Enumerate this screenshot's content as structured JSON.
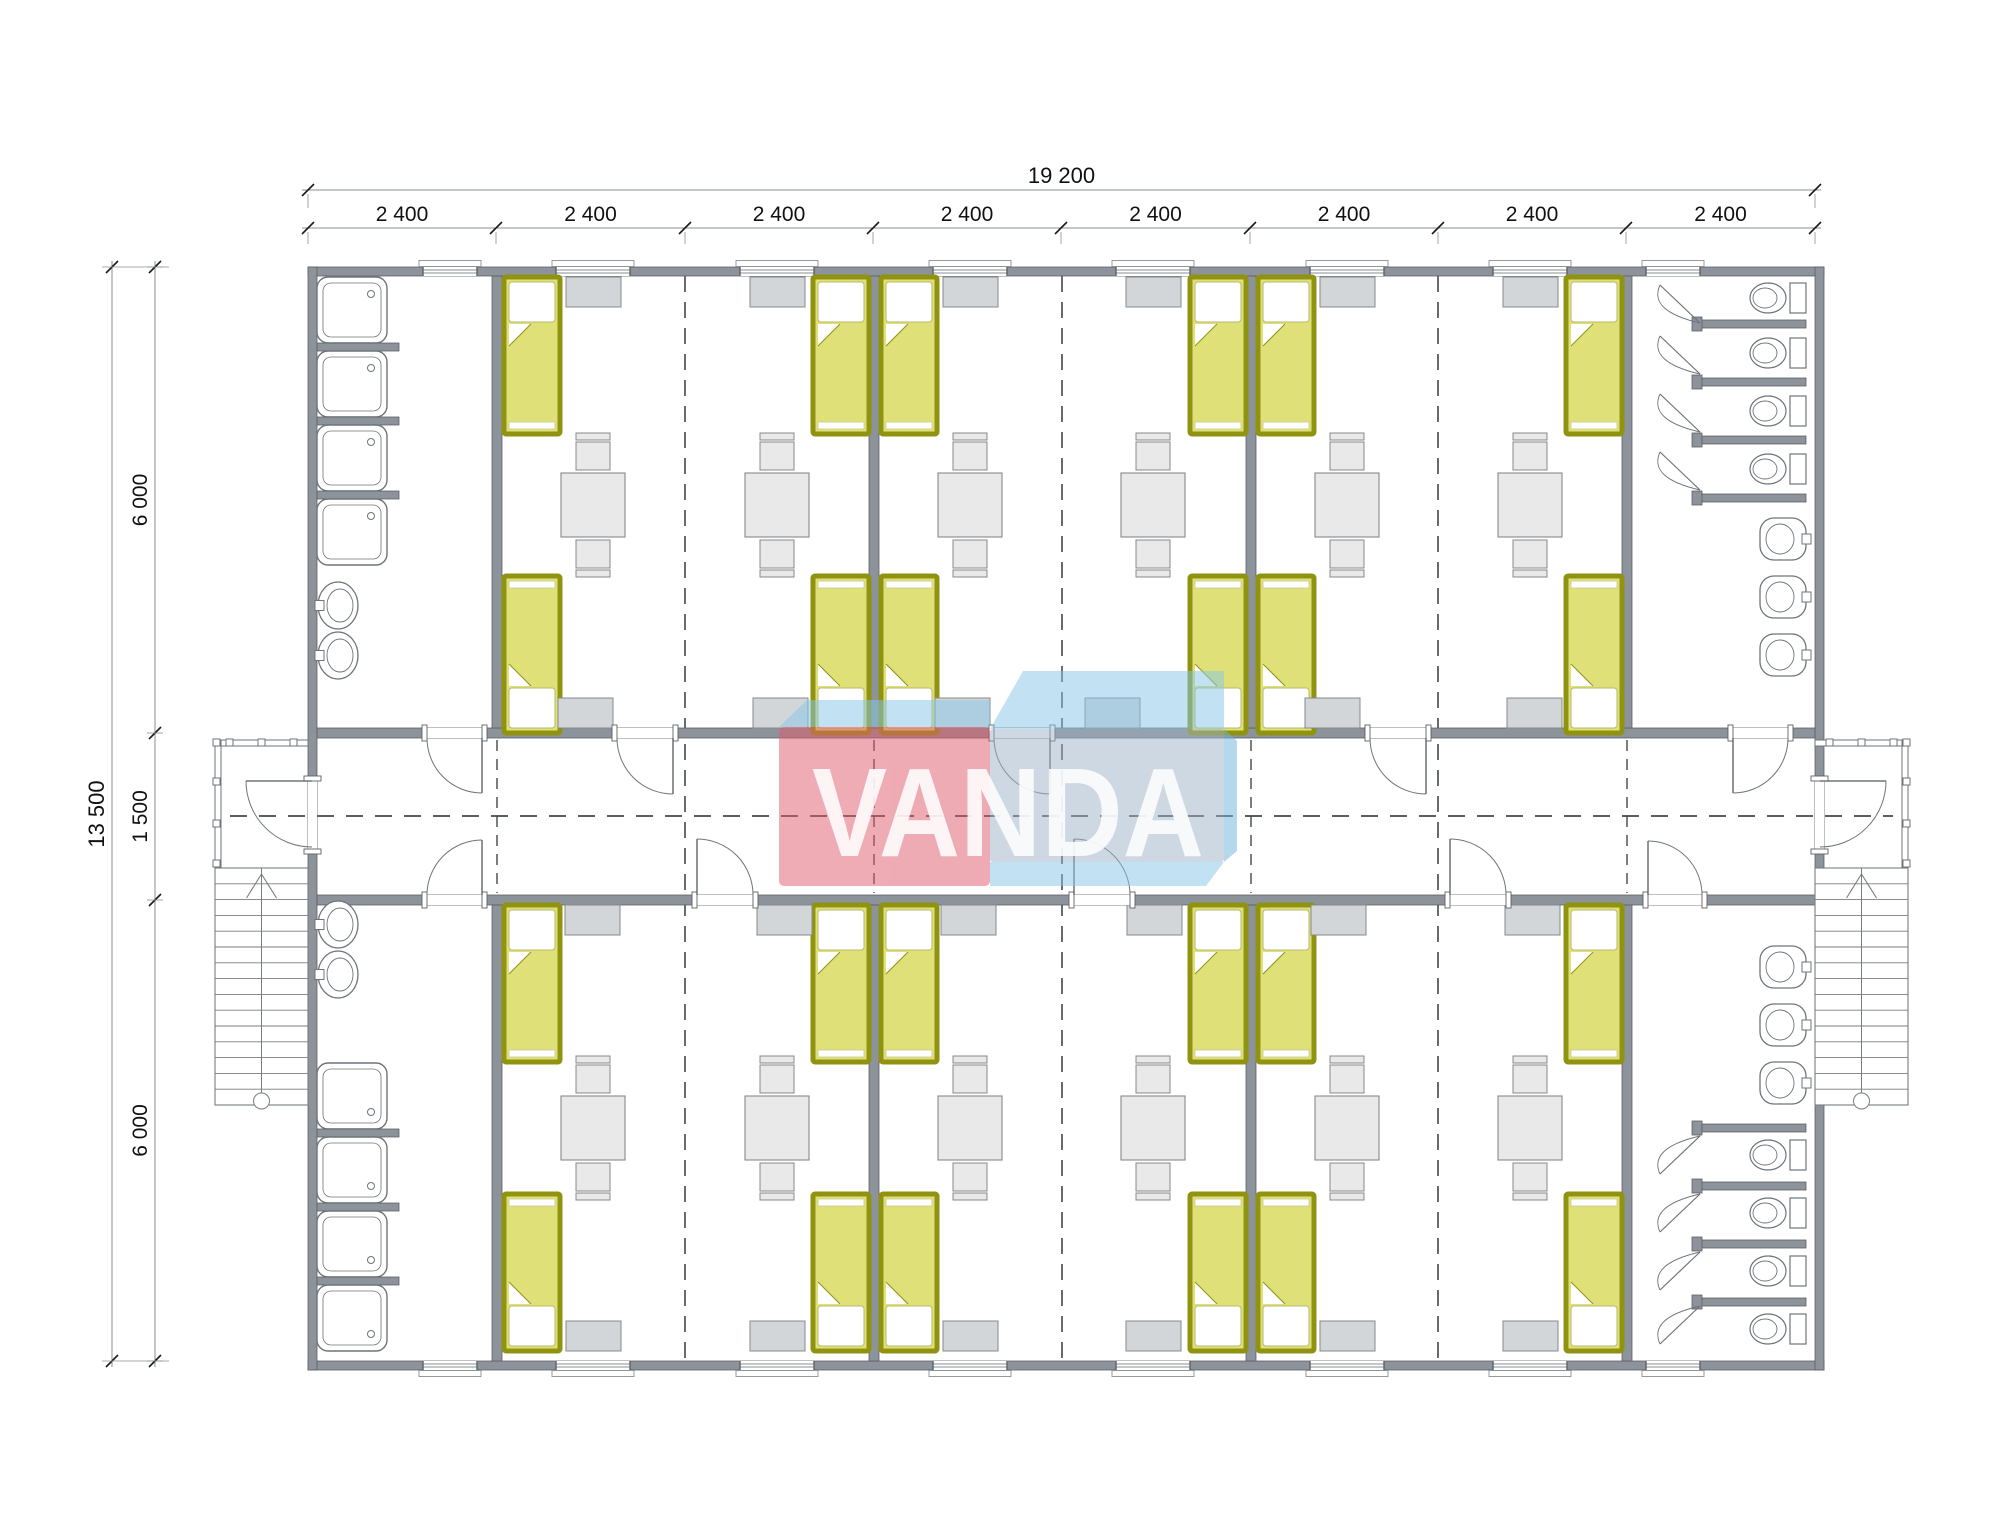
{
  "title": "Modular dormitory floor plan",
  "watermark": {
    "text": "VANDA",
    "red": "#e15a6b",
    "blue_top": "#87c7e9",
    "blue_front": "#9db3c7",
    "blue_edge": "#6fb3dd"
  },
  "dimensions": {
    "top_total_label": "19 200",
    "top_segment_label": "2 400",
    "top_segment_count": 8,
    "left_total_label": "13 500",
    "left_segment_labels": [
      "6 000",
      "1 500",
      "6 000"
    ]
  },
  "colors": {
    "wall": "#8d939a",
    "wallStroke": "#5d6165",
    "bedFill": "#dfe077",
    "bedBorder": "#8f9310",
    "furn": "#e9e9e9",
    "furnStroke": "#85898d",
    "wardrobe": "#d3d6d8",
    "fixture": "#6e747a",
    "dash": "#42474b",
    "dimLine": "#8a8f93",
    "dimTick": "#1a1a1a",
    "stair": "#787d81",
    "textColor": "#111111"
  },
  "geometry": {
    "canvas": {
      "w": 2000,
      "h": 1539
    },
    "bld": {
      "x0": 308,
      "x1": 1815,
      "y0": 267,
      "y1": 1361,
      "wt": 9
    },
    "corr": {
      "t0": 728,
      "t1": 738,
      "b0": 895,
      "b1": 905
    },
    "moduleBoundaries": [
      308,
      496,
      685,
      873,
      1061,
      1250,
      1438,
      1626,
      1815
    ],
    "partitionCenters": [
      497,
      874,
      1251,
      1627
    ],
    "jointX": [
      685,
      1062,
      1438
    ],
    "moduleCenters": [
      593,
      777,
      970,
      1153,
      1347,
      1530
    ],
    "centerline": {
      "x0": 230,
      "x1": 1893,
      "y": 816
    },
    "beds": {
      "w": 56,
      "l": 157,
      "leftX": [
        504,
        881,
        1258
      ],
      "rightX": [
        813,
        1190,
        1566
      ],
      "topBandTopY": 277,
      "topBandBotY": 576,
      "botBandTopY": 905,
      "botBandBotY": 1194
    },
    "tables": {
      "size": 64,
      "cyTop": 505,
      "cyBot": 1128
    },
    "wardrobe": {
      "w": 55,
      "h": 30,
      "windowTopY": 277,
      "windowBotY": 1321,
      "corrTopY": 698,
      "corrBotY": 905,
      "corrTopX": [
        558,
        753,
        935,
        1085,
        1305,
        1507
      ],
      "corrBotX": [
        565,
        757,
        941,
        1127,
        1311,
        1505
      ]
    },
    "windows": {
      "roomW": 74,
      "roomX": [
        556,
        740,
        933,
        1116,
        1310,
        1493
      ],
      "washW": 54,
      "washX": [
        423,
        1646
      ]
    },
    "doors": {
      "roomW": 56,
      "topRooms": [
        617,
        994,
        1370
      ],
      "botRooms": [
        697,
        1074,
        1450
      ],
      "washTop": [
        [
          427,
          482
        ],
        [
          1733,
          1788
        ]
      ],
      "washBot": [
        [
          427,
          482
        ],
        [
          1648,
          1702
        ]
      ],
      "endY0": 781,
      "endY1": 849
    },
    "washLeft": {
      "showerX": 317,
      "showerW": 70,
      "showerH": 66,
      "stubW": 82,
      "topShowerY": [
        277,
        351,
        425,
        499
      ],
      "botShowerY": [
        1063,
        1137,
        1211,
        1285
      ],
      "sinkX": 318,
      "sinkW": 40,
      "sinkH": 47,
      "topSinkY": [
        582,
        632
      ],
      "botSinkY": [
        901,
        951
      ]
    },
    "washRight": {
      "stallX": 1700,
      "stallLen": 106,
      "stallT": 8,
      "topStallY": [
        320,
        378,
        436,
        494
      ],
      "botStallY": [
        1124,
        1182,
        1240,
        1298
      ],
      "toiletTopCY": [
        298,
        353,
        411,
        469
      ],
      "toiletBotCY": [
        1155,
        1213,
        1271,
        1329
      ],
      "sinkX": 1760,
      "sinkW": 46,
      "sinkH": 42,
      "topSinkY": [
        518,
        576,
        634
      ],
      "botSinkY": [
        946,
        1004,
        1062
      ]
    },
    "porch": {
      "leftX": 215,
      "rightX": 1815,
      "w": 93,
      "y0": 740,
      "y1": 868,
      "railT": 6
    },
    "stairs": {
      "y0": 868,
      "y1": 1105,
      "treads": 14,
      "circleY": 1101,
      "circleR": 8
    },
    "dims": {
      "topLine1Y": 190,
      "topLine2Y": 228,
      "leftLine1X": 112,
      "leftLine2X": 155,
      "leftTickY": [
        267,
        733,
        900,
        1361
      ]
    },
    "wm": {
      "topFaceLeft": [
        [
          779,
          727
        ],
        [
          807,
          700
        ],
        [
          990,
          700
        ],
        [
          990,
          727
        ]
      ],
      "red": [
        779,
        727,
        211,
        159
      ],
      "topFaceRight": [
        [
          990,
          729
        ],
        [
          1023,
          671
        ],
        [
          1224,
          671
        ],
        [
          1224,
          729
        ]
      ],
      "blueFront": [
        990,
        729,
        234,
        133
      ],
      "edgeRight": [
        [
          1224,
          729
        ],
        [
          1237,
          741
        ],
        [
          1237,
          851
        ],
        [
          1224,
          862
        ]
      ],
      "bottomFace": [
        [
          990,
          862
        ],
        [
          1224,
          862
        ],
        [
          1206,
          886
        ],
        [
          990,
          886
        ]
      ],
      "textX": 1008,
      "textY": 856
    }
  }
}
